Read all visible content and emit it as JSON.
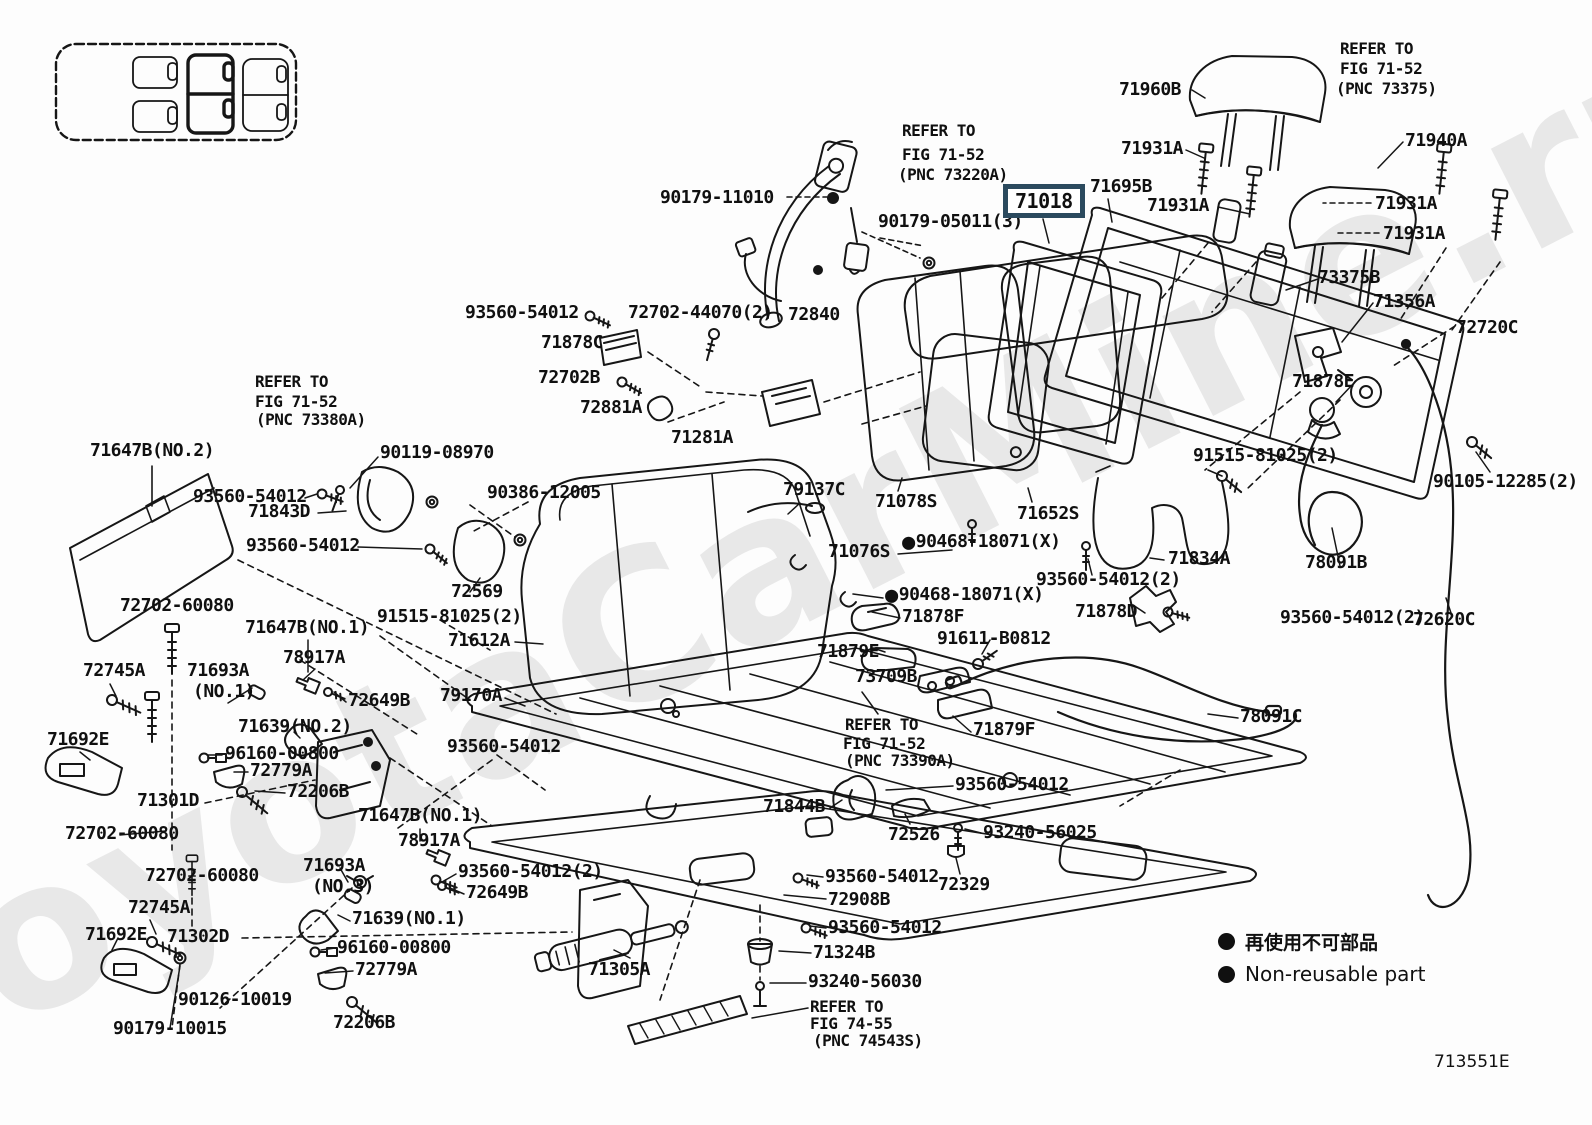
{
  "watermark": "ToyotaCarMine.ru",
  "diagram_code": "713551E",
  "legend": {
    "marker": "non-reusable-dot",
    "jp": "再使用不可部品",
    "en": "Non-reusable part"
  },
  "highlight_color": "#2b4a5e",
  "labels": [
    {
      "t": "REFER TO",
      "x": 902,
      "y": 122,
      "s": 16
    },
    {
      "t": "FIG 71-52",
      "x": 902,
      "y": 146,
      "s": 16
    },
    {
      "t": "(PNC 73220A)",
      "x": 898,
      "y": 166,
      "s": 16
    },
    {
      "t": "90179-11010",
      "x": 660,
      "y": 188
    },
    {
      "t": "90179-05011(3)",
      "x": 878,
      "y": 212
    },
    {
      "t": "71018",
      "x": 1003,
      "y": 184,
      "b": true
    },
    {
      "t": "71695B",
      "x": 1090,
      "y": 177
    },
    {
      "t": "71931A",
      "x": 1121,
      "y": 139
    },
    {
      "t": "71931A",
      "x": 1147,
      "y": 196
    },
    {
      "t": "71960B",
      "x": 1119,
      "y": 80
    },
    {
      "t": "REFER TO",
      "x": 1340,
      "y": 40,
      "s": 16
    },
    {
      "t": "FIG 71-52",
      "x": 1340,
      "y": 60,
      "s": 16
    },
    {
      "t": "(PNC 73375)",
      "x": 1336,
      "y": 80,
      "s": 16
    },
    {
      "t": "71940A",
      "x": 1405,
      "y": 131
    },
    {
      "t": "71931A",
      "x": 1375,
      "y": 194
    },
    {
      "t": "71931A",
      "x": 1383,
      "y": 224
    },
    {
      "t": "73375B",
      "x": 1318,
      "y": 268
    },
    {
      "t": "71356A",
      "x": 1373,
      "y": 292
    },
    {
      "t": "72720C",
      "x": 1456,
      "y": 318
    },
    {
      "t": "93560-54012",
      "x": 465,
      "y": 303
    },
    {
      "t": "72702-44070(2)",
      "x": 628,
      "y": 303
    },
    {
      "t": "72840",
      "x": 788,
      "y": 305
    },
    {
      "t": "71878C",
      "x": 541,
      "y": 333
    },
    {
      "t": "72702B",
      "x": 538,
      "y": 368
    },
    {
      "t": "72881A",
      "x": 580,
      "y": 398
    },
    {
      "t": "71281A",
      "x": 671,
      "y": 428
    },
    {
      "t": "71878E",
      "x": 1292,
      "y": 372
    },
    {
      "t": "91515-81025(2)",
      "x": 1193,
      "y": 446
    },
    {
      "t": "90105-12285(2)",
      "x": 1433,
      "y": 472
    },
    {
      "t": "71647B(NO.2)",
      "x": 90,
      "y": 441
    },
    {
      "t": "REFER TO",
      "x": 255,
      "y": 373,
      "s": 16
    },
    {
      "t": "FIG 71-52",
      "x": 255,
      "y": 393,
      "s": 16
    },
    {
      "t": "(PNC 73380A)",
      "x": 256,
      "y": 411,
      "s": 16
    },
    {
      "t": "90119-08970",
      "x": 380,
      "y": 443
    },
    {
      "t": "93560-54012",
      "x": 193,
      "y": 487
    },
    {
      "t": "71843D",
      "x": 248,
      "y": 502
    },
    {
      "t": "90386-12005",
      "x": 487,
      "y": 483
    },
    {
      "t": "93560-54012",
      "x": 246,
      "y": 536
    },
    {
      "t": "72569",
      "x": 451,
      "y": 582
    },
    {
      "t": "79137C",
      "x": 783,
      "y": 480
    },
    {
      "t": "71078S",
      "x": 875,
      "y": 492
    },
    {
      "t": "71652S",
      "x": 1017,
      "y": 504
    },
    {
      "t": "71076S",
      "x": 828,
      "y": 542
    },
    {
      "t": "90468-18071(X)",
      "x": 902,
      "y": 531,
      "d": true
    },
    {
      "t": "93560-54012(2)",
      "x": 1036,
      "y": 570
    },
    {
      "t": "71834A",
      "x": 1168,
      "y": 549
    },
    {
      "t": "90468-18071(X)",
      "x": 885,
      "y": 584,
      "d": true
    },
    {
      "t": "71878F",
      "x": 902,
      "y": 607
    },
    {
      "t": "71878D",
      "x": 1075,
      "y": 602
    },
    {
      "t": "93560-54012(2)",
      "x": 1280,
      "y": 608
    },
    {
      "t": "78091B",
      "x": 1305,
      "y": 553
    },
    {
      "t": "72620C",
      "x": 1413,
      "y": 610
    },
    {
      "t": "91611-B0812",
      "x": 937,
      "y": 629
    },
    {
      "t": "71879E",
      "x": 817,
      "y": 642
    },
    {
      "t": "73709B",
      "x": 855,
      "y": 667
    },
    {
      "t": "71879F",
      "x": 973,
      "y": 720
    },
    {
      "t": "78091C",
      "x": 1240,
      "y": 707
    },
    {
      "t": "REFER TO",
      "x": 845,
      "y": 716,
      "s": 16
    },
    {
      "t": "FIG 71-52",
      "x": 843,
      "y": 735,
      "s": 16
    },
    {
      "t": "(PNC 73390A)",
      "x": 845,
      "y": 752,
      "s": 16
    },
    {
      "t": "93560-54012",
      "x": 955,
      "y": 775
    },
    {
      "t": "71844B",
      "x": 763,
      "y": 797
    },
    {
      "t": "72526",
      "x": 888,
      "y": 825
    },
    {
      "t": "93240-56025",
      "x": 983,
      "y": 823
    },
    {
      "t": "93560-54012",
      "x": 825,
      "y": 867
    },
    {
      "t": "72329",
      "x": 938,
      "y": 875
    },
    {
      "t": "72908B",
      "x": 828,
      "y": 890
    },
    {
      "t": "93560-54012",
      "x": 828,
      "y": 918
    },
    {
      "t": "71324B",
      "x": 813,
      "y": 943
    },
    {
      "t": "93240-56030",
      "x": 808,
      "y": 972
    },
    {
      "t": "REFER TO",
      "x": 810,
      "y": 998,
      "s": 16
    },
    {
      "t": "FIG 74-55",
      "x": 810,
      "y": 1015,
      "s": 16
    },
    {
      "t": "(PNC 74543S)",
      "x": 813,
      "y": 1032,
      "s": 16
    },
    {
      "t": "71305A",
      "x": 588,
      "y": 960
    },
    {
      "t": "91515-81025(2)",
      "x": 377,
      "y": 607
    },
    {
      "t": "71612A",
      "x": 448,
      "y": 631
    },
    {
      "t": "71647B(NO.1)",
      "x": 245,
      "y": 618
    },
    {
      "t": "78917A",
      "x": 283,
      "y": 648
    },
    {
      "t": "72745A",
      "x": 83,
      "y": 661
    },
    {
      "t": "71693A",
      "x": 187,
      "y": 661
    },
    {
      "t": "(NO.1)",
      "x": 193,
      "y": 682
    },
    {
      "t": "72649B",
      "x": 348,
      "y": 691
    },
    {
      "t": "79170A",
      "x": 440,
      "y": 686
    },
    {
      "t": "71639(NO.2)",
      "x": 238,
      "y": 717
    },
    {
      "t": "93560-54012",
      "x": 447,
      "y": 737
    },
    {
      "t": "96160-00800",
      "x": 225,
      "y": 744
    },
    {
      "t": "72779A",
      "x": 250,
      "y": 761
    },
    {
      "t": "71692E",
      "x": 47,
      "y": 730
    },
    {
      "t": "72206B",
      "x": 287,
      "y": 782
    },
    {
      "t": "71301D",
      "x": 137,
      "y": 791
    },
    {
      "t": "72702-60080",
      "x": 65,
      "y": 824
    },
    {
      "t": "72702-60080",
      "x": 120,
      "y": 596
    },
    {
      "t": "72702-60080",
      "x": 145,
      "y": 866
    },
    {
      "t": "71693A",
      "x": 303,
      "y": 856
    },
    {
      "t": "(NO.3)",
      "x": 312,
      "y": 877
    },
    {
      "t": "71647B(NO.1)",
      "x": 358,
      "y": 806
    },
    {
      "t": "78917A",
      "x": 398,
      "y": 831
    },
    {
      "t": "93560-54012(2)",
      "x": 458,
      "y": 862
    },
    {
      "t": "72649B",
      "x": 466,
      "y": 883
    },
    {
      "t": "71639(NO.1)",
      "x": 352,
      "y": 909
    },
    {
      "t": "96160-00800",
      "x": 337,
      "y": 938
    },
    {
      "t": "72779A",
      "x": 355,
      "y": 960
    },
    {
      "t": "72745A",
      "x": 128,
      "y": 898
    },
    {
      "t": "71692E",
      "x": 85,
      "y": 925
    },
    {
      "t": "71302D",
      "x": 167,
      "y": 927
    },
    {
      "t": "90126-10019",
      "x": 178,
      "y": 990
    },
    {
      "t": "90179-10015",
      "x": 113,
      "y": 1019
    },
    {
      "t": "72206B",
      "x": 333,
      "y": 1013
    }
  ]
}
